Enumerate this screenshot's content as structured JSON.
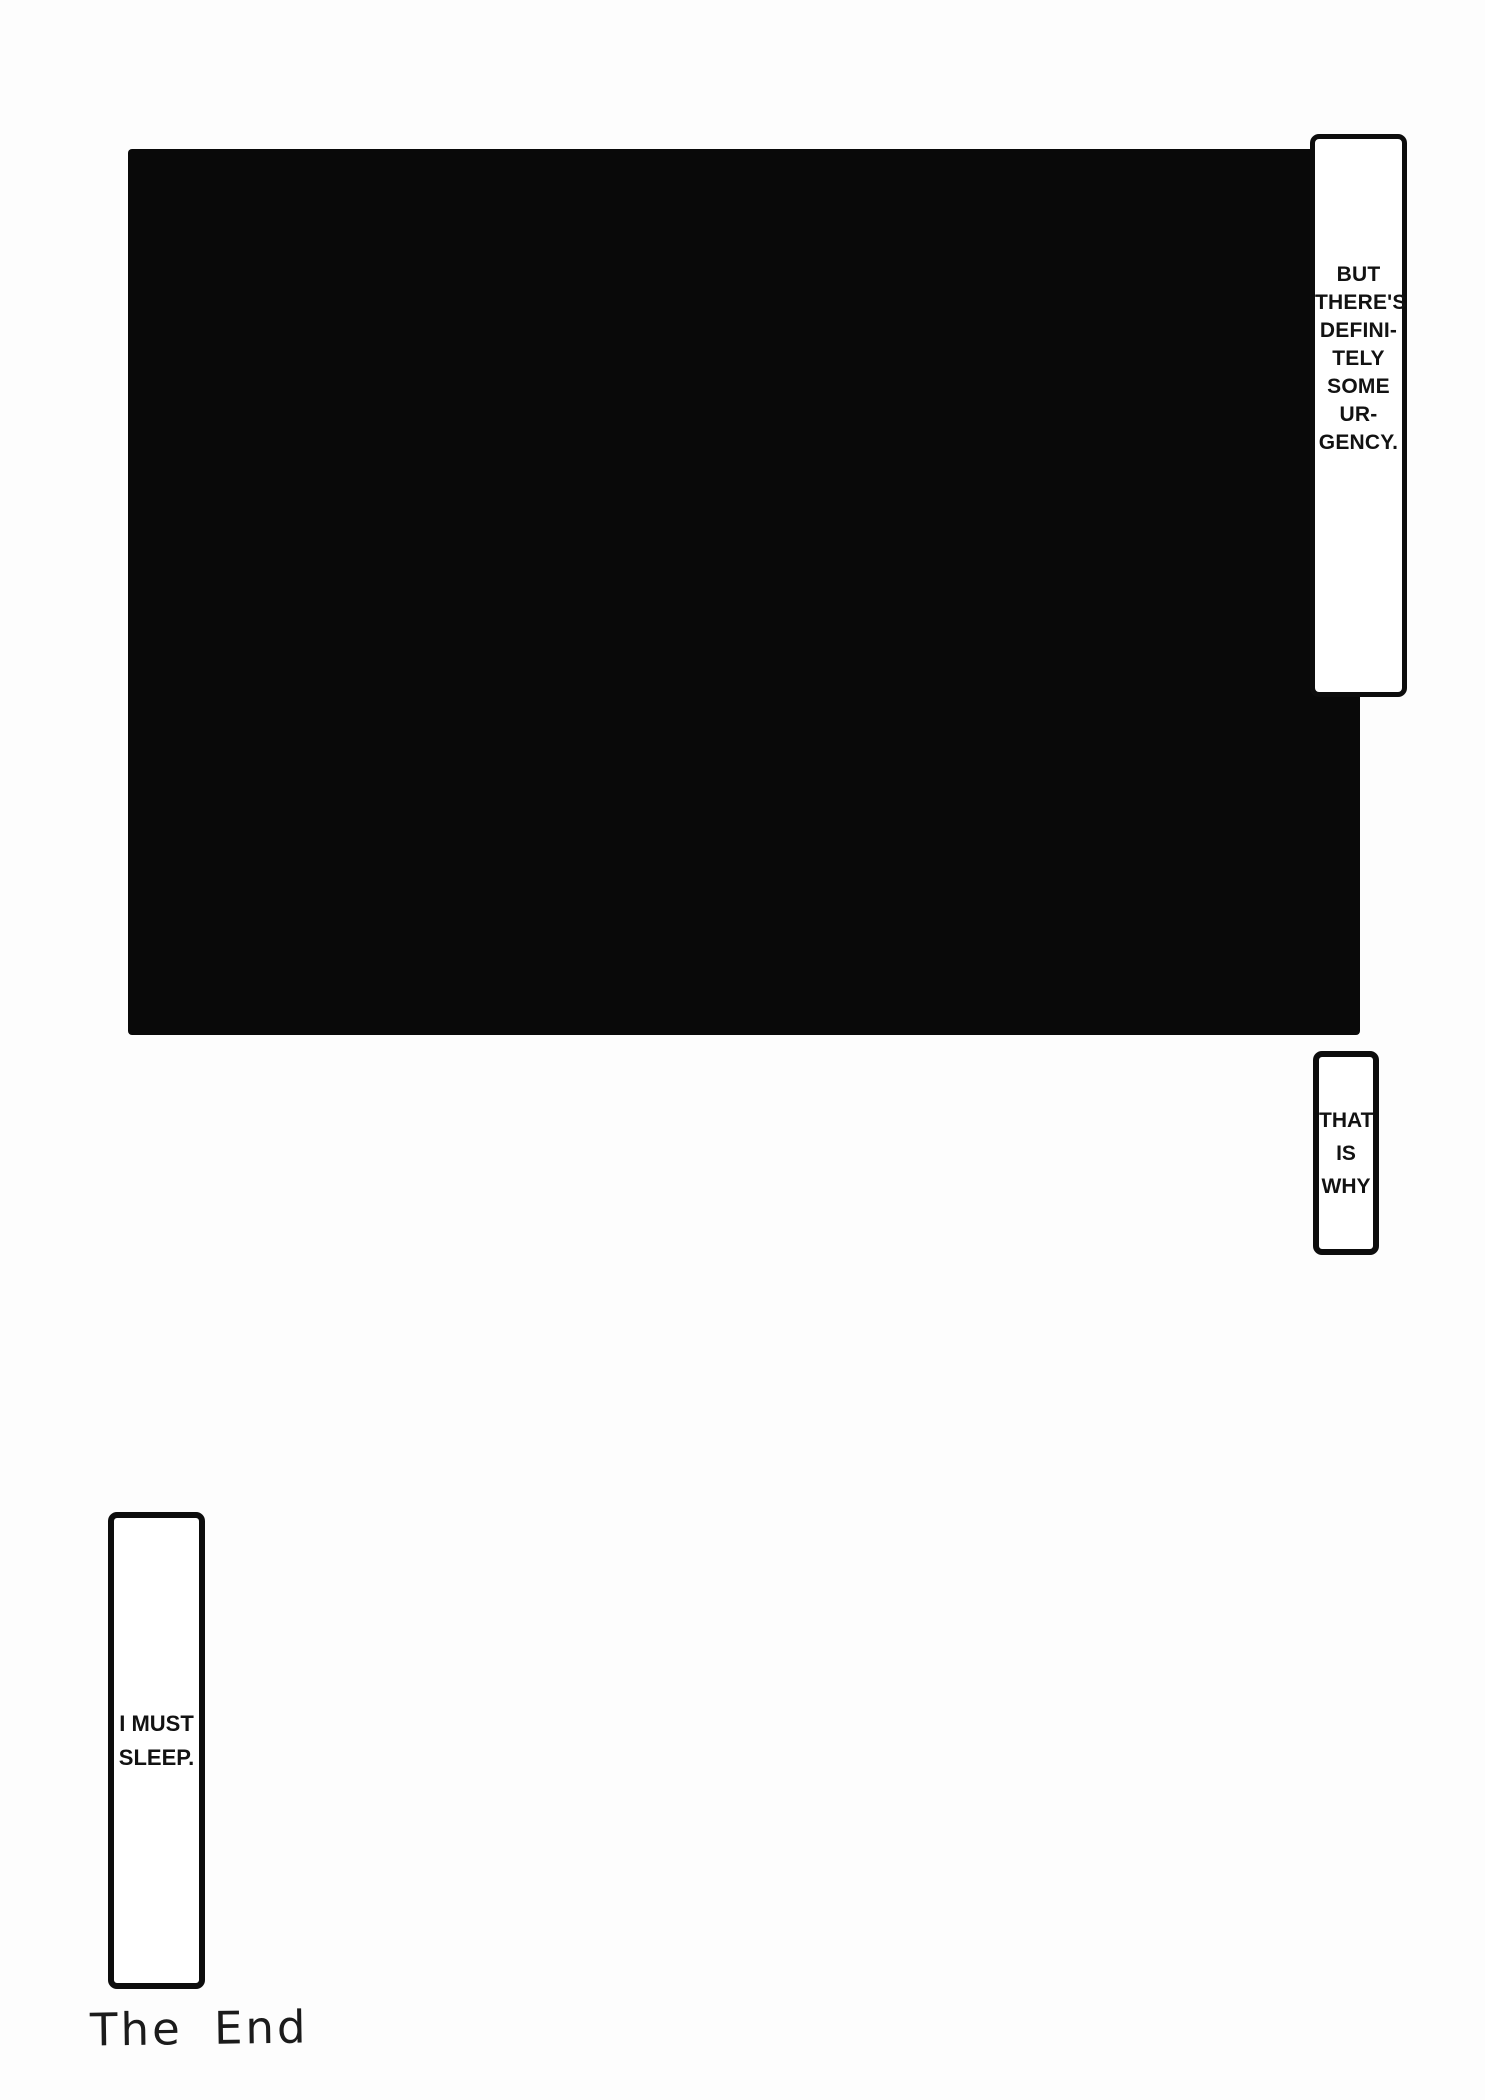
{
  "page": {
    "type": "manga-page",
    "colors": {
      "background": "#fdfdfd",
      "panel_fill": "#090909",
      "bubble_fill": "#ffffff",
      "bubble_border": "#0d0d0d",
      "ink": "#121212"
    }
  },
  "panel": {
    "description": "large solid black panel"
  },
  "bubbles": {
    "urgency": {
      "lines": [
        "BUT",
        "THERE'S",
        "DEFINI-",
        "TELY",
        "SOME",
        "UR-",
        "GENCY."
      ]
    },
    "that_is_why": {
      "lines": [
        "THAT",
        "IS",
        "WHY"
      ]
    },
    "i_must_sleep": {
      "lines": [
        "I MUST",
        "SLEEP."
      ]
    }
  },
  "footer": {
    "the_end": "The End"
  }
}
